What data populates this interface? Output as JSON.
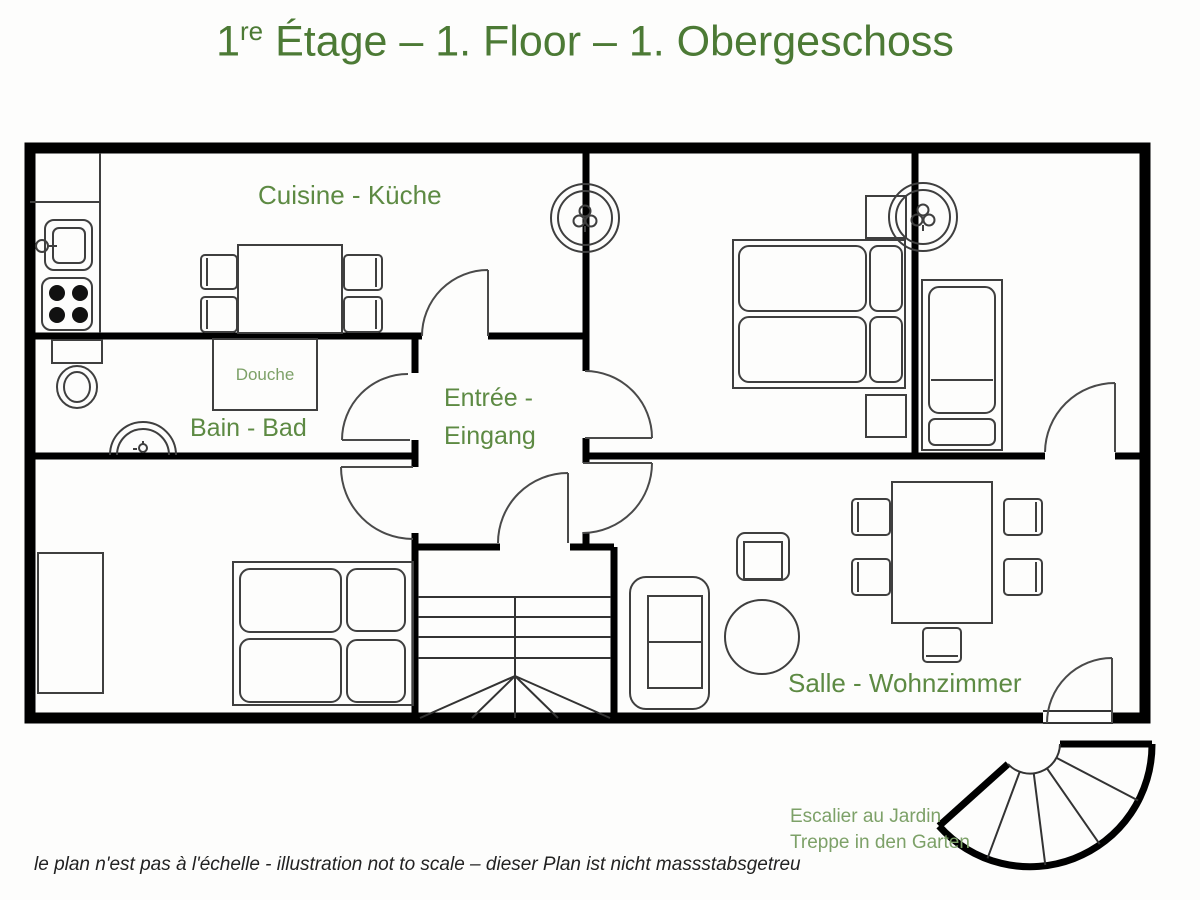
{
  "title": {
    "num": "1",
    "sup": "re",
    "rest": " Étage – 1. Floor – 1. Obergeschoss"
  },
  "rooms": {
    "kitchen": "Cuisine - Küche",
    "shower": "Douche",
    "bathroom": "Bain - Bad",
    "entrance_line1": "Entrée -",
    "entrance_line2": "Eingang",
    "living_room": "Salle - Wohnzimmer"
  },
  "annotations": {
    "garden_stairs_line1": "Escalier au Jardin",
    "garden_stairs_line2": "Treppe in den Garten",
    "disclaimer": "le plan n'est pas à l'échelle - illustration not to scale – dieser Plan ist nicht massstabsgetreu"
  },
  "colors": {
    "title_green": "#4c7a35",
    "label_green": "#5d8a43",
    "light_label_green": "#7da168",
    "wall_black": "#000000",
    "furniture_gray": "#3f3f3f"
  }
}
